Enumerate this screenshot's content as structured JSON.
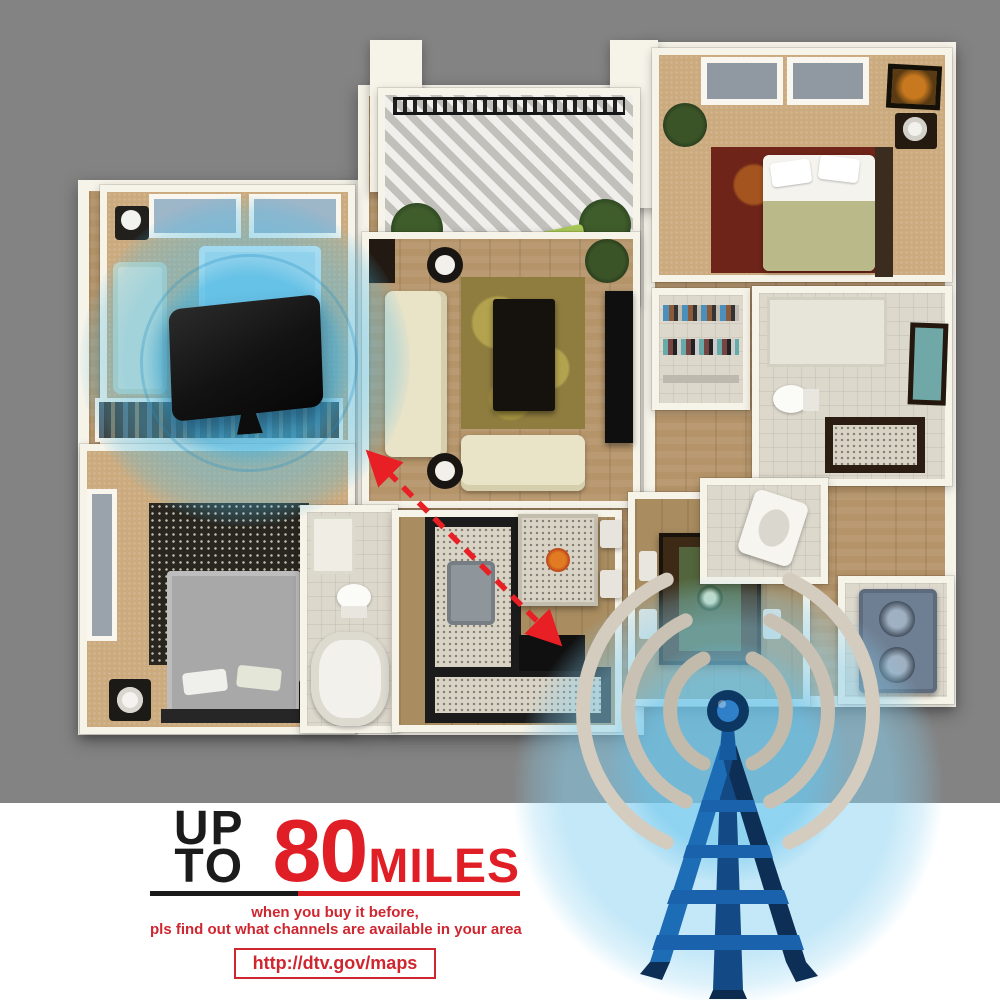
{
  "promo": {
    "up_to_label": "UP TO",
    "range_value": "80",
    "range_unit": "MILES",
    "note_line_1": "when you buy it before,",
    "note_line_2": "pls find out what channels are available in your area",
    "map_url": "http://dtv.gov/maps"
  },
  "icons": {
    "antenna": "flat-indoor-tv-antenna-icon",
    "tower": "broadcast-tower-icon",
    "signal_waves": "signal-waves-icon",
    "range_arrow": "distance-double-arrow-icon",
    "coverage": "signal-coverage-circle-icon"
  },
  "colors": {
    "background_gray": "#838383",
    "panel_white": "#ffffff",
    "accent_red": "#e01e25",
    "text_black": "#1b1b1b",
    "signal_cyan": "#49bbe7",
    "tower_blue_light": "#1d6cb6",
    "tower_blue_dark": "#0d2f55",
    "wave_gray": "#c9c2b4",
    "antenna_black": "#141414",
    "wall_cream": "#f6f3e9",
    "floor_wood": "#b59469"
  }
}
